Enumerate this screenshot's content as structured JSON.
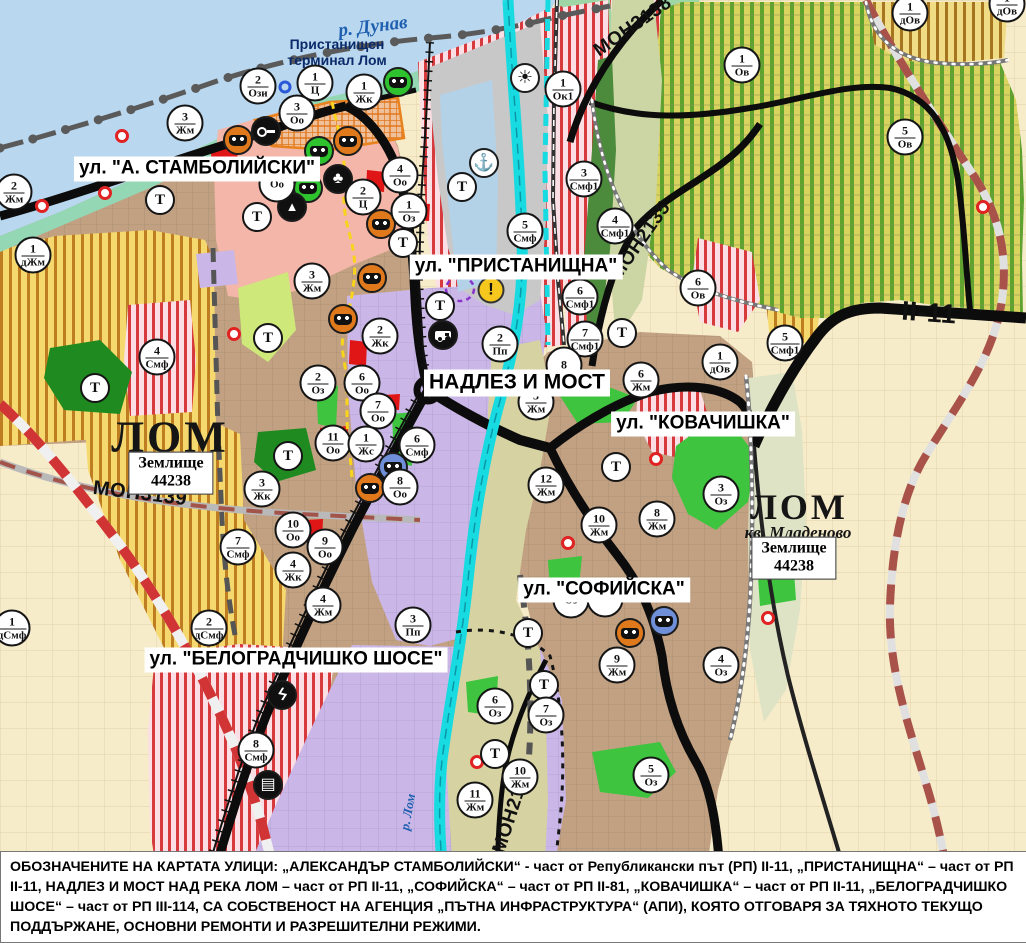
{
  "colors": {
    "water": "#b9d7ee",
    "river_lom": "#17dbe0",
    "road_main": "#0c0c0c",
    "bypass_red": "#d03434",
    "marker_border": "#151515",
    "monument_orange": "#e0791c",
    "monument_green": "#2ec22e",
    "monument_blue": "#6f8fd8",
    "warning_yellow": "#f6c81d"
  },
  "map": {
    "transport_label": "Т",
    "port_label": {
      "line1": "Пристанищен",
      "line2": "терминал Лом",
      "x": 337,
      "y": 52
    },
    "water_labels": [
      {
        "text": "р. Дунав",
        "x": 373,
        "y": 27,
        "rot": -7,
        "size": 19
      },
      {
        "text": "р. Лом",
        "x": 408,
        "y": 812,
        "rot": -80,
        "size": 13
      }
    ],
    "street_labels": [
      {
        "text": "ул. \"А. СТАМБОЛИЙСКИ\"",
        "x": 197,
        "y": 169,
        "size": 19
      },
      {
        "text": "ул. \"ПРИСТАНИЩНА\"",
        "x": 516,
        "y": 267,
        "size": 19
      },
      {
        "text": "НАДЛЕЗ И МОСТ",
        "x": 517,
        "y": 383,
        "size": 21
      },
      {
        "text": "ул. \"КОВАЧИШКА\"",
        "x": 703,
        "y": 424,
        "size": 19
      },
      {
        "text": "ул. \"СОФИЙСКА\"",
        "x": 604,
        "y": 590,
        "size": 19
      },
      {
        "text": "ул. \"БЕЛОГРАДЧИШКО ШОСЕ\"",
        "x": 296,
        "y": 660,
        "size": 19
      }
    ],
    "road_labels": [
      {
        "text": "МОН3139",
        "x": 140,
        "y": 494,
        "rot": 7,
        "size": 20
      },
      {
        "text": "МОН3138",
        "x": 633,
        "y": 27,
        "rot": -35,
        "size": 19
      },
      {
        "text": "МОН2135",
        "x": 641,
        "y": 241,
        "rot": -55,
        "size": 19
      },
      {
        "text": "МОН2136",
        "x": 513,
        "y": 810,
        "rot": -72,
        "size": 19
      },
      {
        "text": "II-11",
        "x": 929,
        "y": 313,
        "rot": 4,
        "size": 27
      }
    ],
    "area_labels": [
      {
        "text": "ЛОМ",
        "x": 170,
        "y": 437,
        "size": 44
      },
      {
        "text": "ЛОМ",
        "x": 799,
        "y": 507,
        "size": 36
      }
    ],
    "sub_label": {
      "text": "кв. Младеново",
      "x": 798,
      "y": 533
    },
    "plot_boxes": [
      {
        "line1": "Землище",
        "line2": "44238",
        "x": 171,
        "y": 473
      },
      {
        "line1": "Землище",
        "line2": "44238",
        "x": 794,
        "y": 558
      }
    ],
    "zone_markers": [
      {
        "n": "2",
        "c": "Жм",
        "x": 14,
        "y": 192
      },
      {
        "n": "3",
        "c": "Жм",
        "x": 185,
        "y": 123
      },
      {
        "n": "2",
        "c": "Ози",
        "x": 258,
        "y": 86
      },
      {
        "n": "1",
        "c": "Ц",
        "x": 315,
        "y": 83
      },
      {
        "n": "3",
        "c": "Оо",
        "x": 297,
        "y": 113
      },
      {
        "n": "1",
        "c": "Жк",
        "x": 364,
        "y": 92
      },
      {
        "n": "1",
        "c": "дЖм",
        "x": 33,
        "y": 255
      },
      {
        "n": "4",
        "c": "Оо",
        "x": 400,
        "y": 175
      },
      {
        "n": "2",
        "c": "Ц",
        "x": 363,
        "y": 197
      },
      {
        "n": "1",
        "c": "Оз",
        "x": 409,
        "y": 211
      },
      {
        "n": "",
        "c": "Оо",
        "x": 277,
        "y": 184
      },
      {
        "n": "1",
        "c": "Ок1",
        "x": 563,
        "y": 89
      },
      {
        "n": "3",
        "c": "Смф1",
        "x": 584,
        "y": 179
      },
      {
        "n": "4",
        "c": "Смф1",
        "x": 615,
        "y": 226
      },
      {
        "n": "5",
        "c": "Смф",
        "x": 525,
        "y": 231
      },
      {
        "n": "6",
        "c": "Смф1",
        "x": 580,
        "y": 297
      },
      {
        "n": "7",
        "c": "Смф1",
        "x": 585,
        "y": 339
      },
      {
        "n": "2",
        "c": "Пп",
        "x": 500,
        "y": 344
      },
      {
        "n": "6",
        "c": "Ов",
        "x": 698,
        "y": 288
      },
      {
        "n": "1",
        "c": "дОв",
        "x": 720,
        "y": 362
      },
      {
        "n": "1",
        "c": "Ов",
        "x": 742,
        "y": 65
      },
      {
        "n": "5",
        "c": "Ов",
        "x": 905,
        "y": 137
      },
      {
        "n": "1",
        "c": "дОв",
        "x": 910,
        "y": 13
      },
      {
        "n": "1",
        "c": "дОв",
        "x": 1007,
        "y": 4
      },
      {
        "n": "5",
        "c": "Смф1",
        "x": 785,
        "y": 343
      },
      {
        "n": "3",
        "c": "Жм",
        "x": 312,
        "y": 281
      },
      {
        "n": "2",
        "c": "Жк",
        "x": 380,
        "y": 336
      },
      {
        "n": "6",
        "c": "Оо",
        "x": 362,
        "y": 383
      },
      {
        "n": "7",
        "c": "Оо",
        "x": 378,
        "y": 411
      },
      {
        "n": "2",
        "c": "Оз",
        "x": 318,
        "y": 383
      },
      {
        "n": "11",
        "c": "Оо",
        "x": 333,
        "y": 443
      },
      {
        "n": "1",
        "c": "Жс",
        "x": 366,
        "y": 444
      },
      {
        "n": "6",
        "c": "Смф",
        "x": 417,
        "y": 445
      },
      {
        "n": "3",
        "c": "Жк",
        "x": 262,
        "y": 489
      },
      {
        "n": "8",
        "c": "Оо",
        "x": 400,
        "y": 487
      },
      {
        "n": "4",
        "c": "Смф",
        "x": 157,
        "y": 357
      },
      {
        "n": "7",
        "c": "Смф",
        "x": 238,
        "y": 547
      },
      {
        "n": "10",
        "c": "Оо",
        "x": 293,
        "y": 530
      },
      {
        "n": "9",
        "c": "Оо",
        "x": 325,
        "y": 547
      },
      {
        "n": "4",
        "c": "Жк",
        "x": 293,
        "y": 570
      },
      {
        "n": "4",
        "c": "Жм",
        "x": 323,
        "y": 605
      },
      {
        "n": "2",
        "c": "дСмф",
        "x": 209,
        "y": 628
      },
      {
        "n": "1",
        "c": "дСмф",
        "x": 12,
        "y": 628
      },
      {
        "n": "3",
        "c": "Пп",
        "x": 413,
        "y": 625
      },
      {
        "n": "8",
        "c": "Смф",
        "x": 256,
        "y": 750
      },
      {
        "n": "5",
        "c": "Жм",
        "x": 536,
        "y": 402
      },
      {
        "n": "6",
        "c": "Жм",
        "x": 641,
        "y": 380
      },
      {
        "n": "8",
        "c": "",
        "x": 564,
        "y": 365
      },
      {
        "n": "12",
        "c": "Жм",
        "x": 546,
        "y": 485
      },
      {
        "n": "10",
        "c": "Жм",
        "x": 599,
        "y": 525
      },
      {
        "n": "8",
        "c": "Жм",
        "x": 657,
        "y": 519
      },
      {
        "n": "3",
        "c": "Оз",
        "x": 721,
        "y": 494
      },
      {
        "n": "",
        "c": "Оз",
        "x": 571,
        "y": 600
      },
      {
        "n": "",
        "c": "Оз",
        "x": 605,
        "y": 599
      },
      {
        "n": "9",
        "c": "Жм",
        "x": 617,
        "y": 665
      },
      {
        "n": "4",
        "c": "Оз",
        "x": 721,
        "y": 665
      },
      {
        "n": "6",
        "c": "Оз",
        "x": 495,
        "y": 706
      },
      {
        "n": "7",
        "c": "Оз",
        "x": 546,
        "y": 715
      },
      {
        "n": "5",
        "c": "Оз",
        "x": 651,
        "y": 775
      },
      {
        "n": "10",
        "c": "Жм",
        "x": 520,
        "y": 777
      },
      {
        "n": "11",
        "c": "Жм",
        "x": 475,
        "y": 800
      }
    ],
    "transport_markers": [
      {
        "x": 160,
        "y": 200
      },
      {
        "x": 257,
        "y": 217
      },
      {
        "x": 403,
        "y": 243
      },
      {
        "x": 462,
        "y": 187
      },
      {
        "x": 440,
        "y": 306
      },
      {
        "x": 622,
        "y": 333
      },
      {
        "x": 268,
        "y": 338
      },
      {
        "x": 288,
        "y": 456
      },
      {
        "x": 95,
        "y": 388
      },
      {
        "x": 616,
        "y": 467
      },
      {
        "x": 528,
        "y": 633
      },
      {
        "x": 544,
        "y": 685
      },
      {
        "x": 495,
        "y": 754
      }
    ],
    "poi_icons": [
      {
        "type": "ic-monument ic-orange",
        "name": "cultural-monument-icon",
        "x": 238,
        "y": 140
      },
      {
        "type": "ic-monument ic-orange",
        "name": "cultural-monument-icon",
        "x": 348,
        "y": 141
      },
      {
        "type": "ic-monument ic-orange",
        "name": "cultural-monument-icon",
        "x": 381,
        "y": 224
      },
      {
        "type": "ic-monument ic-orange",
        "name": "cultural-monument-icon",
        "x": 372,
        "y": 278
      },
      {
        "type": "ic-monument ic-orange",
        "name": "cultural-monument-icon",
        "x": 343,
        "y": 319
      },
      {
        "type": "ic-monument ic-orange",
        "name": "cultural-monument-icon",
        "x": 370,
        "y": 488
      },
      {
        "type": "ic-monument ic-orange",
        "name": "cultural-monument-icon",
        "x": 630,
        "y": 633
      },
      {
        "type": "ic-monument ic-green",
        "name": "cultural-monument-icon",
        "x": 398,
        "y": 82
      },
      {
        "type": "ic-monument ic-green",
        "name": "cultural-monument-icon",
        "x": 319,
        "y": 151
      },
      {
        "type": "ic-monument ic-green",
        "name": "cultural-monument-icon",
        "x": 308,
        "y": 188
      },
      {
        "type": "ic-monument ic-blue",
        "name": "cultural-monument-icon",
        "x": 393,
        "y": 467
      },
      {
        "type": "ic-monument ic-blue",
        "name": "cultural-monument-icon",
        "x": 664,
        "y": 621
      },
      {
        "type": "ic-black ic-key",
        "name": "key-icon",
        "x": 266,
        "y": 131
      },
      {
        "type": "ic-black ic-trefoil",
        "name": "trefoil-icon",
        "x": 338,
        "y": 179
      },
      {
        "type": "ic-black ic-arch",
        "name": "arch-icon",
        "x": 292,
        "y": 207
      },
      {
        "type": "ic-white ic-anchor",
        "name": "anchor-icon",
        "x": 484,
        "y": 163
      },
      {
        "type": "ic-white ic-sun",
        "name": "port-sun-icon",
        "x": 525,
        "y": 78
      },
      {
        "type": "ic-black ic-truck",
        "name": "truck-icon",
        "x": 443,
        "y": 335
      },
      {
        "type": "ic-warning",
        "name": "warning-icon",
        "x": 491,
        "y": 290
      },
      {
        "type": "ic-black ic-lightning",
        "name": "lightning-icon",
        "x": 282,
        "y": 695
      },
      {
        "type": "ic-black ic-crossing",
        "name": "rail-crossing-icon",
        "x": 268,
        "y": 785
      },
      {
        "type": "ic-ring",
        "name": "blue-ring-icon",
        "x": 285,
        "y": 87
      }
    ],
    "red_dots": [
      {
        "x": 122,
        "y": 136
      },
      {
        "x": 105,
        "y": 193
      },
      {
        "x": 42,
        "y": 206
      },
      {
        "x": 234,
        "y": 334
      },
      {
        "x": 656,
        "y": 459
      },
      {
        "x": 568,
        "y": 543
      },
      {
        "x": 477,
        "y": 762
      },
      {
        "x": 768,
        "y": 618
      },
      {
        "x": 983,
        "y": 207
      }
    ]
  },
  "footer": {
    "text": "ОБОЗНАЧЕНИТЕ НА КАРТАТА УЛИЦИ: „АЛЕКСАНДЪР СТАМБОЛИЙСКИ“ - част от Републикански път (РП) II-11, „ПРИСТАНИЩНА“ – част от РП II-11, НАДЛЕЗ И МОСТ НАД РЕКА ЛОМ – част от РП II-11, „СОФИЙСКА“ – част от РП II-81, „КОВАЧИШКА“ – част от РП II-11, „БЕЛОГРАДЧИШКО ШОСЕ“ – част от РП III-114, СА СОБСТВЕНОСТ НА АГЕНЦИЯ „ПЪТНА ИНФРАСТРУКТУРА“ (АПИ), КОЯТО ОТГОВАРЯ ЗА ТЯХНОТО ТЕКУЩО ПОДДЪРЖАНЕ, ОСНОВНИ РЕМОНТИ И РАЗРЕШИТЕЛНИ РЕЖИМИ."
  }
}
